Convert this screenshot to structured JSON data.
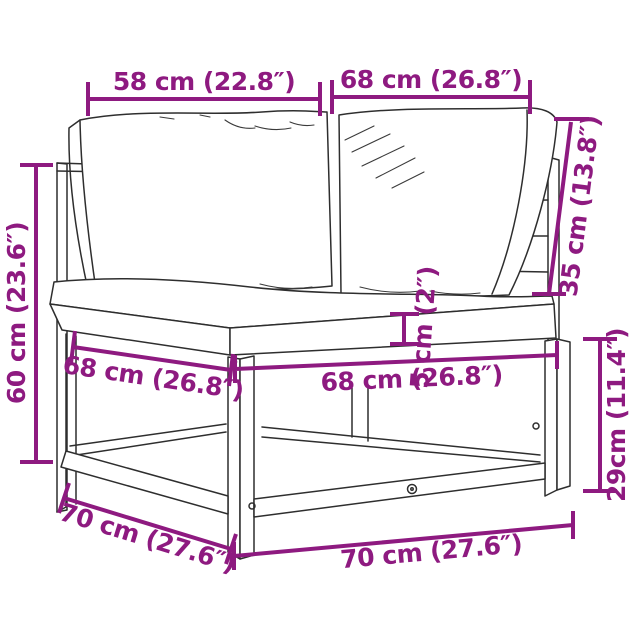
{
  "colors": {
    "background": "#ffffff",
    "dimension_accent": "#8e1a80",
    "sketch_line": "#2e2e2e"
  },
  "figure": {
    "subject": "corner-sofa-section-with-cushions-and-pallet-base"
  },
  "dimensions": [
    {
      "name": "backrest-width-left",
      "label": "58 cm (22.8″)"
    },
    {
      "name": "backrest-width-right",
      "label": "68 cm (26.8″)"
    },
    {
      "name": "backrest-height",
      "label": "35 cm (13.8″)"
    },
    {
      "name": "overall-height",
      "label": "60 cm (23.6″)"
    },
    {
      "name": "seat-board-thickness",
      "label": "5 cm (2″)"
    },
    {
      "name": "seat-depth-left",
      "label": "68 cm (26.8″)"
    },
    {
      "name": "seat-width-front",
      "label": "68 cm (26.8″)"
    },
    {
      "name": "base-height",
      "label": "29cm (11.4″)"
    },
    {
      "name": "base-depth-left",
      "label": "70 cm (27.6″)"
    },
    {
      "name": "base-width-front",
      "label": "70 cm (27.6″)"
    }
  ]
}
